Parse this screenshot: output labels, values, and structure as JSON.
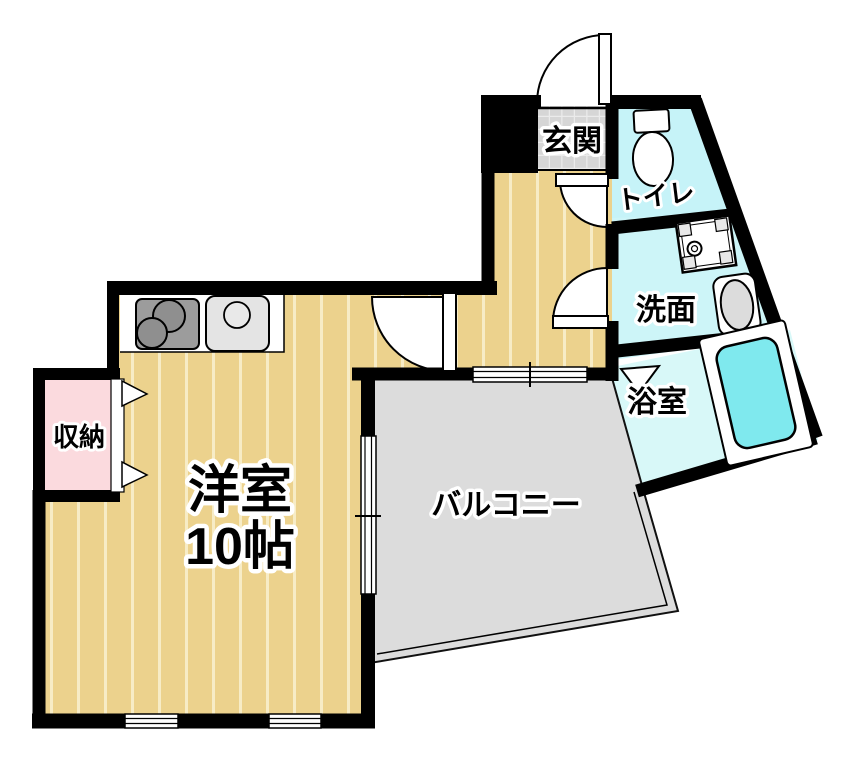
{
  "plan_title": "1K apartment floor plan",
  "rooms": {
    "genkan": {
      "label": "玄関"
    },
    "toilet": {
      "label": "トイレ"
    },
    "washroom": {
      "label": "洗面"
    },
    "bathroom": {
      "label": "浴室"
    },
    "closet": {
      "label": "収納"
    },
    "main_room": {
      "label": "洋室",
      "size": "10帖"
    },
    "balcony": {
      "label": "バルコニー"
    }
  },
  "icons": {
    "entrance_door": "swing-door-icon",
    "room_door": "swing-door-icon",
    "toilet_door": "swing-door-icon",
    "washroom_door": "swing-door-icon",
    "bath_door": "folding-door-icon",
    "closet_doors": "folding-door-icon",
    "toilet_fixture": "toilet-icon",
    "washing_machine": "washing-machine-icon",
    "sink": "sink-icon",
    "bathtub": "bathtub-icon",
    "stove": "stove-icon",
    "kitchen_sink": "kitchen-sink-icon",
    "windows": "window-icon"
  },
  "colors": {
    "wall": "#000000",
    "floor_tan": "#ecd28d",
    "floor_stripe": "#f7ecc6",
    "toilet_cyan": "#c6f3f8",
    "washroom_cyan": "#cdf5f8",
    "bathroom_cyan": "#d8f8f8",
    "bathtub_cyan": "#7fe9ee",
    "balcony_gray": "#dcdcdc",
    "genkan_gray": "#d6d6d6",
    "closet_pink": "#fbdade",
    "fixture_white": "#ffffff",
    "stove_gray": "#9c9c9c"
  }
}
